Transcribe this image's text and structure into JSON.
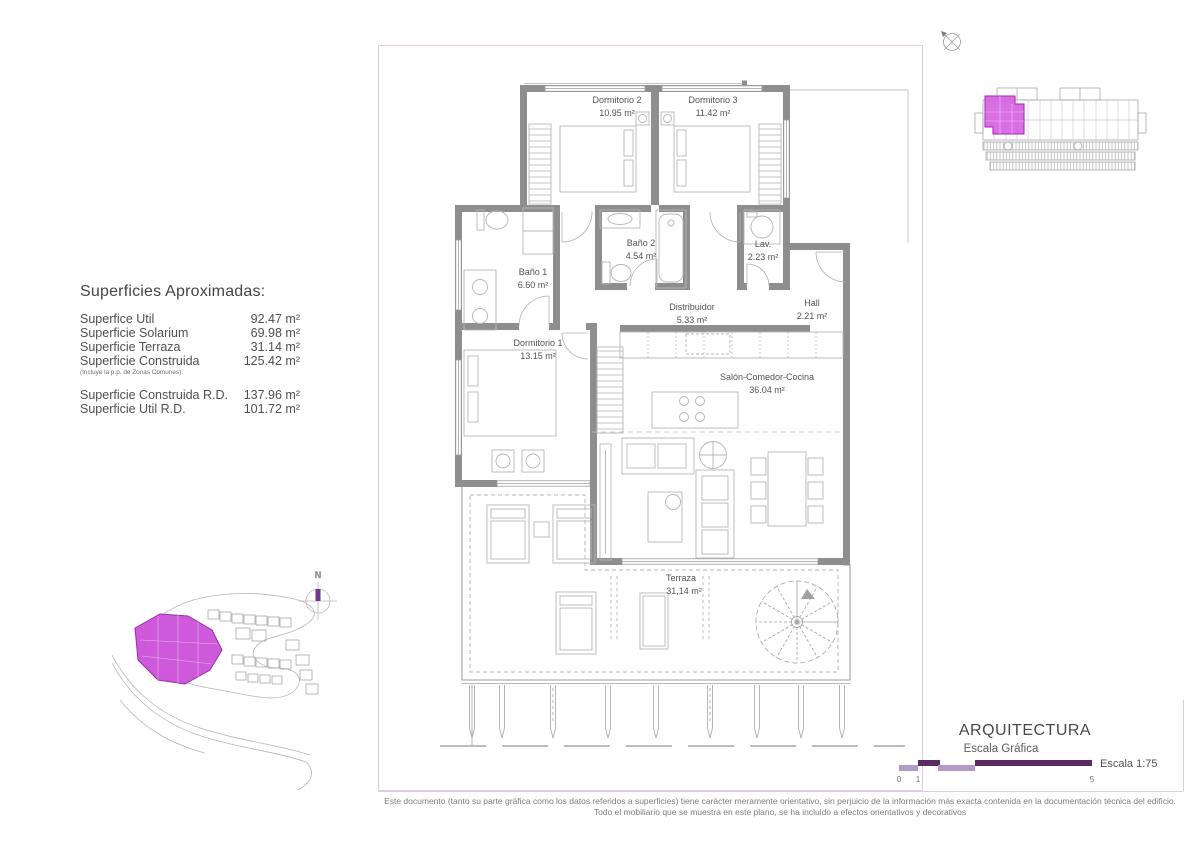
{
  "surfaces": {
    "title": "Superficies Aproximadas:",
    "rows": [
      {
        "label": "Superfice Util",
        "value": "92.47 m²"
      },
      {
        "label": "Superficie Solarium",
        "value": "69.98 m²"
      },
      {
        "label": "Superficie Terraza",
        "value": "31.14 m²"
      },
      {
        "label": "Superficie Construida",
        "value": "125.42 m²",
        "note": "(Incluye la p.p. de Zonas Comunes)."
      },
      {
        "label": "Superficie Construida R.D.",
        "value": "137.96 m²"
      },
      {
        "label": "Superficie Util R.D.",
        "value": "101.72 m²"
      }
    ]
  },
  "rooms": {
    "d2": {
      "name": "Dormitorio 2",
      "area": "10.95 m²"
    },
    "d3": {
      "name": "Dormitorio 3",
      "area": "11.42 m²"
    },
    "b1": {
      "name": "Baño 1",
      "area": "6.60 m²"
    },
    "b2": {
      "name": "Baño 2",
      "area": "4.54 m²"
    },
    "lav": {
      "name": "Lav.",
      "area": "2.23 m²"
    },
    "dist": {
      "name": "Distribuidor",
      "area": "5.33 m²"
    },
    "hall": {
      "name": "Hall",
      "area": "2.21 m²"
    },
    "d1": {
      "name": "Dormitorio 1",
      "area": "13.15 m²"
    },
    "salon": {
      "name": "Salón-Comedor-Cocina",
      "area": "36.04 m²"
    },
    "terraza": {
      "name": "Terraza",
      "area": "31,14 m²"
    }
  },
  "site_plan": {
    "north_label": "N"
  },
  "titleblock": {
    "title": "ARQUITECTURA",
    "scale_label": "Escala Gráfica",
    "scale_ratio": "Escala 1:75",
    "ticks": [
      "0",
      "1",
      "5"
    ]
  },
  "disclaimer": {
    "line1": "Este documento (tanto su parte gráfica como los datos referidos a superficies) tiene carácter meramente orientativo, sin perjuicio de la información más exacta contenida en la documentación técnica del edificio.",
    "line2": "Todo el mobiliario que se muestra en este plano, se ha incluido a efectos orientativos y decorativos"
  },
  "colors": {
    "highlight_magenta": "#d45fe0",
    "highlight_border": "#a722b5",
    "scale_light_purple": "#b49bc7",
    "scale_dark_purple": "#5c2a63",
    "wall_gray": "#8e8e8e",
    "plan_border_pink": "#e0cbe0"
  }
}
